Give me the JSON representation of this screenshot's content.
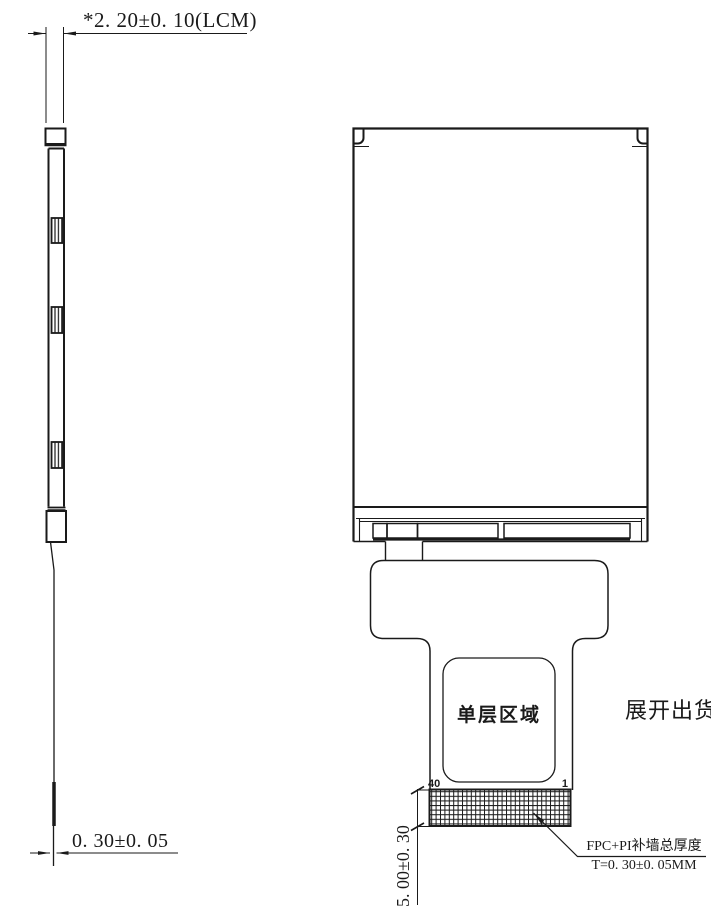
{
  "drawing": {
    "background": "#ffffff",
    "line_color": "#1a1a1a",
    "side_view": {
      "lcm_thickness_dim": "*2. 20±0. 10(LCM)",
      "fpc_thickness_dim": "0. 30±0. 05"
    },
    "front_view": {
      "single_layer_area_label": "单层区域",
      "ship_unfolded_note": "展开出货",
      "pin_last": "40",
      "pin_first": "1",
      "connector_depth_dim": "5. 00±0. 30",
      "fpc_note_title": "FPC+PI补墙总厚度",
      "fpc_note_value": "T=0. 30±0. 05MM"
    }
  }
}
